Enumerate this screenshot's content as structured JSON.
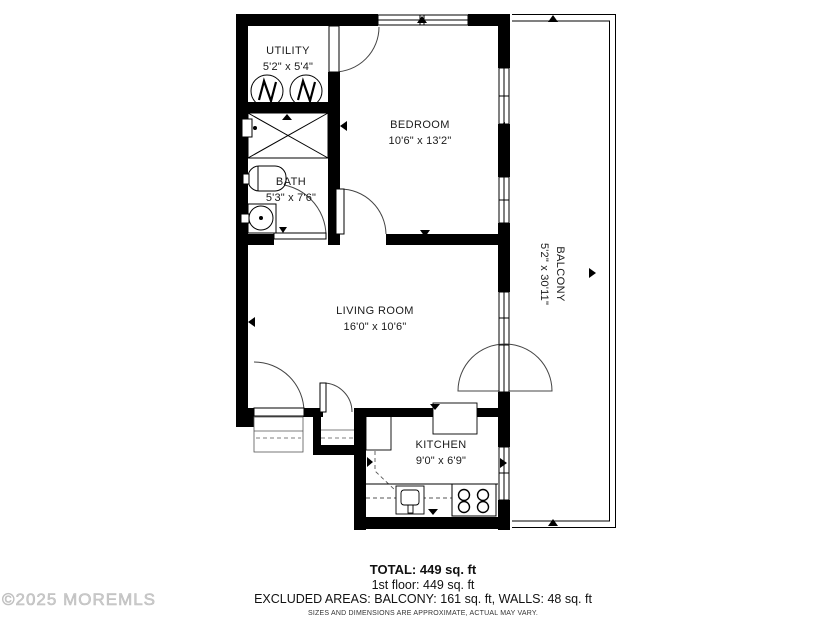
{
  "rooms": {
    "utility": {
      "label": "UTILITY",
      "dims": "5'2\" x 5'4\""
    },
    "bath": {
      "label": "BATH",
      "dims": "5'3\" x 7'6\""
    },
    "bedroom": {
      "label": "BEDROOM",
      "dims": "10'6\" x 13'2\""
    },
    "living_room": {
      "label": "LIVING ROOM",
      "dims": "16'0\" x 10'6\""
    },
    "kitchen": {
      "label": "KITCHEN",
      "dims": "9'0\" x 6'9\""
    },
    "balcony": {
      "label": "BALCONY",
      "dims": "5'2\" x 30'11\""
    }
  },
  "summary": {
    "total": "TOTAL: 449 sq. ft",
    "floor": "1st floor: 449 sq. ft",
    "excluded": "EXCLUDED AREAS: BALCONY: 161 sq. ft, WALLS: 48 sq. ft",
    "disclaimer": "SIZES AND DIMENSIONS ARE APPROXIMATE, ACTUAL MAY VARY."
  },
  "watermark": "©2025 MOREMLS",
  "colors": {
    "walls": "#000000",
    "text": "#1a1a1a",
    "watermark": "#cccccc"
  }
}
